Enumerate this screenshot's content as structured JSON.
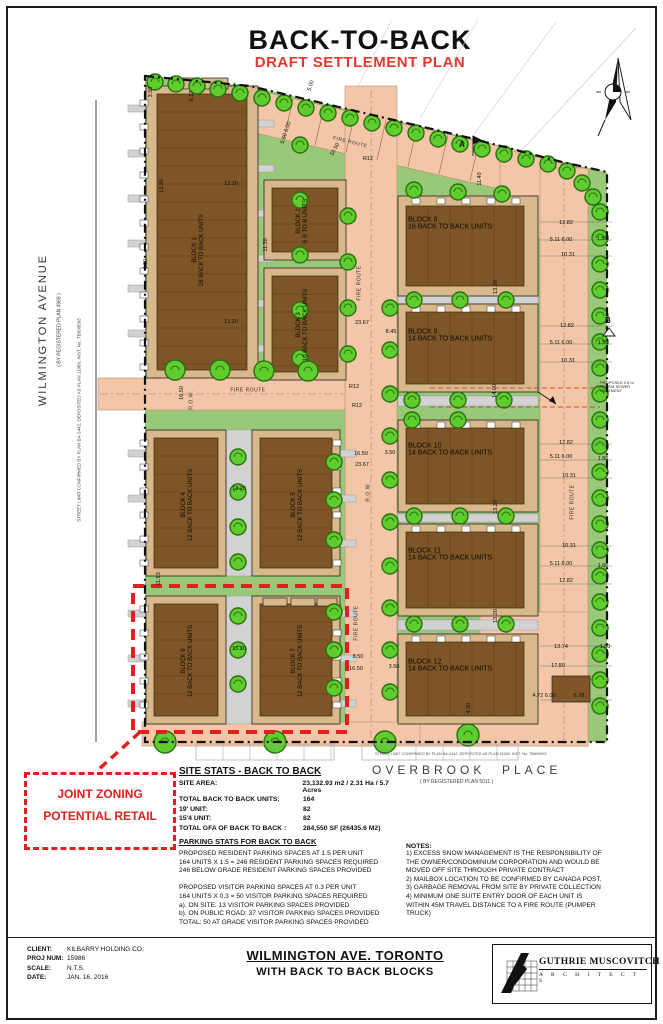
{
  "sheet": {
    "title": "BACK-TO-BACK",
    "subtitle": "DRAFT SETTLEMENT PLAN"
  },
  "streets": {
    "west_name": "WILMINGTON   AVENUE",
    "west_plan_ref": "( BY REGISTERED PLAN 4969 )",
    "west_street_limit": "STREET LIMIT CONFIRMED BY PLAN BA-2442, DEPOSITED AS PLAN 11989, INST. No. TB699593",
    "south_name_1": "OVERBROOK",
    "south_name_2": "PLACE",
    "south_plan_ref": "( BY REGISTERED PLAN 5011 )",
    "south_street_limit": "STREET LIMIT CONFIRMED BY PLAN BA-2442, DEPOSITED AS PLAN 11989, INST. No. TB699593"
  },
  "zone_callout": {
    "line1": "JOINT ZONING",
    "line2": "POTENTIAL RETAIL"
  },
  "plan": {
    "fire_route_label": "FIRE ROUTE",
    "row_label": "R.O.W.",
    "marker_a": "A",
    "marker_b": "B",
    "easement_note": [
      "PROPOSED 0.5 m",
      "STORM SEWER",
      "EASEMENT"
    ],
    "blocks": [
      {
        "label": "BLOCK 1",
        "units": "28 BACK TO BACK UNITS"
      },
      {
        "label": "BLOCK 2",
        "units": "6 B TO B UNITS"
      },
      {
        "label": "BLOCK 3",
        "units": "10 BACK TO BACK UNITS"
      },
      {
        "label": "BLOCK 4",
        "units": "12 BACK TO BACK UNITS"
      },
      {
        "label": "BLOCK 5",
        "units": "12 BACK TO BACK UNITS"
      },
      {
        "label": "BLOCK 6",
        "units": "12 BACK TO BACK UNITS"
      },
      {
        "label": "BLOCK 7",
        "units": "12 BACK TO BACK UNITS"
      },
      {
        "label": "BLOCK 8",
        "units": "16 BACK TO BACK UNITS"
      },
      {
        "label": "BLOCK 9",
        "units": "14 BACK TO BACK UNITS"
      },
      {
        "label": "BLOCK 10",
        "units": "14 BACK TO BACK UNITS"
      },
      {
        "label": "BLOCK 11",
        "units": "14 BACK TO BACK UNITS"
      },
      {
        "label": "BLOCK 12",
        "units": "14 BACK TO BACK UNITS"
      }
    ],
    "dims": [
      "3.50",
      "6.17",
      "13.30",
      "5.00",
      "5.60 6.00",
      "16.50",
      "R12",
      "13.20",
      "11.38",
      "13.20",
      "23.67",
      "16.50",
      "R12",
      "R12",
      "4.00",
      "16.50",
      "23.67",
      "11.93",
      "13.20",
      "13.20",
      "8.50",
      "16.50",
      "11.40",
      "12.82",
      "5.11 6.00",
      "1.50",
      "10.31",
      "12.82",
      "5.11 6.00",
      "1.50",
      "10.31",
      "12.82",
      "5.11 6.00",
      "1.50",
      "10.31",
      "10.31",
      "5.11 6.00",
      "1.50",
      "12.82",
      "13.20",
      "14.00",
      "13.20",
      "13.20",
      "13.74",
      "1.50",
      "17.50",
      "4.72 6.00",
      "6.78",
      "3.50",
      "4.50",
      "3.50",
      "8.45"
    ]
  },
  "site_stats": {
    "heading": "SITE STATS - BACK TO BACK",
    "rows": [
      {
        "label": "SITE AREA:",
        "value": "23,132.93 m2 / 2.31 Ha / 5.7 Acres"
      },
      {
        "label": "TOTAL BACK TO BACK UNITS:",
        "value": "164"
      },
      {
        "label": "19' UNIT:",
        "value": "82"
      },
      {
        "label": "15'4 UNIT:",
        "value": "82"
      },
      {
        "label": "TOTAL GFA OF BACK TO BACK :",
        "value": "284,550 SF (26435.6 M2)"
      }
    ],
    "parking_heading": "PARKING STATS FOR BACK TO BACK",
    "parking_lines": [
      "PROPOSED RESIDENT PARKING SPACES AT 1.5 PER UNIT",
      "164 UNITS X 1.5 = 246 RESIDENT PARKING SPACES REQUIRED",
      "246 BELOW GRADE RESIDENT PARKING SPACES PROVIDED",
      "",
      "PROPOSED VISITOR PARKING SPACES AT 0.3 PER UNIT",
      "164 UNITS X 0.3 = 50 VISITOR PARKING SPACES REQUIRED",
      "a). ON SITE: 13 VISITOR PARKING SPACES PROVIDED",
      "b). ON PUBLIC ROAD: 37 VISITOR PARKING SPACES PROVIDED",
      "TOTAL: 50 AT GRADE VISITOR PARKING SPACES PROVIDED"
    ]
  },
  "notes": {
    "heading": "NOTES:",
    "lines": [
      "1) EXCESS SNOW MANAGEMENT IS THE RESPONSIBILITY OF",
      "THE OWNER/CONDOMINIUM CORPORATION AND WOULD BE",
      "MOVED OFF SITE THROUGH PRIVATE CONTRACT",
      "2) MAILBOX LOCATION TO BE CONFIRMED BY CANADA POST.",
      "3) GARBAGE REMOVAL FROM SITE BY PRIVATE COLLECTION",
      "4) MINIMUM ONE SUITE ENTRY DOOR OF EACH UNIT IS",
      "WITHIN 45M TRAVEL DISTANCE TO A FIRE ROUTE (PUMPER",
      "TRUCK)"
    ]
  },
  "title_block": {
    "client_label": "CLIENT:",
    "client": "KILBARRY HOLDING CO.",
    "proj_label": "PROJ NUM:",
    "proj": "15986",
    "scale_label": "SCALE:",
    "scale": "N.T.S.",
    "date_label": "DATE:",
    "date": "JAN. 16, 2016",
    "drawing_title": "WILMINGTON AVE. TORONTO",
    "drawing_subtitle": "WITH BACK TO BACK BLOCKS",
    "firm": "GUTHRIE MUSCOVITCH",
    "firm_sub": "A R C H I T E C T S"
  },
  "colors": {
    "road": "#f2c6a6",
    "green": "#98c878",
    "tree": "#5ecd2d",
    "tree_outline": "#2c6e12",
    "building": "#7e5526",
    "building_trim": "#d9b98c",
    "walk": "#d2d2d2",
    "accent_red": "#e02020",
    "draft_red": "#e8372e"
  }
}
